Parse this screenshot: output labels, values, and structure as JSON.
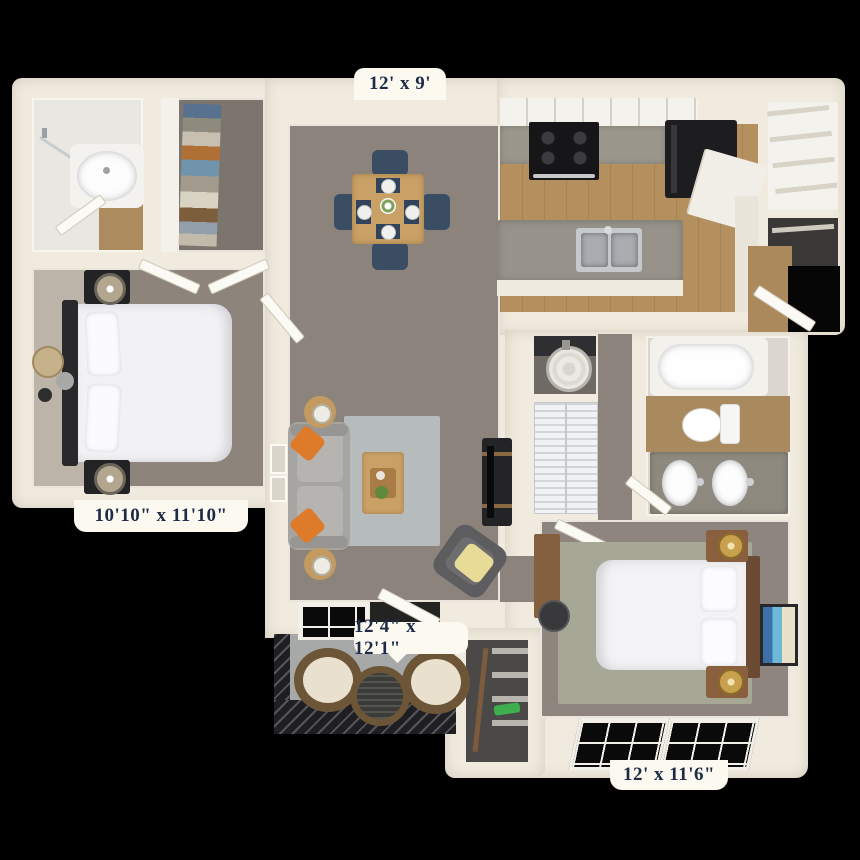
{
  "floorplan": {
    "background_color": "#000000",
    "wall_color": "#f1ebdf",
    "label_style": {
      "background": "#fcf9f1",
      "text_color": "#1d2b47"
    },
    "dimensions": {
      "dining": "12' x 9'",
      "bedroom1": "10'10\" x 11'10\"",
      "living": "12'4\" x 12'1\"",
      "bedroom2": "12' x 11'6\""
    },
    "palette": {
      "carpet": "#8c847c",
      "carpet_dark": "#7c756d",
      "wood_floor": "#b3905e",
      "granite_counter": "#97928a",
      "cabinet_white": "#f4f2ed",
      "appliance_black": "#1d1d1f",
      "rug_living": "#b6bcbb",
      "rug_bedroom": "#a6a895",
      "sofa_gray": "#a7a5a2",
      "pillow_orange": "#de7b2b",
      "pillow_yellow": "#e8db97",
      "dining_chair_navy": "#3b4d62",
      "table_wood": "#c9a166",
      "nightstand_black": "#232325",
      "nightstand_brown": "#8a5f3e",
      "lamp_gold": "#c8a04e",
      "balcony_floor": "#a6a9a7",
      "railing_dark": "#1f1f23",
      "bedding_white": "#f3f3f5"
    }
  }
}
